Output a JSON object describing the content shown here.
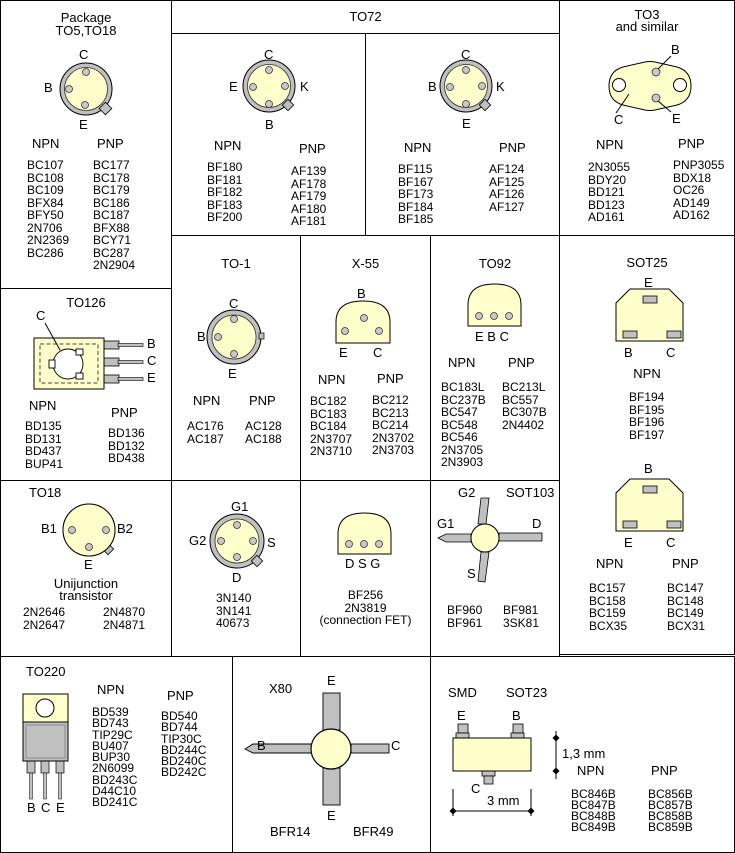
{
  "colors": {
    "body": "#ffffcc",
    "lead": "#c0c0c0",
    "outline": "#000000"
  },
  "to5": {
    "title_line1": "Package",
    "title_line2": "TO5,TO18",
    "pin_c": "C",
    "pin_b": "B",
    "pin_e": "E",
    "npn_label": "NPN",
    "pnp_label": "PNP",
    "npn": [
      "BC107",
      "BC108",
      "BC109",
      "BFX84",
      "BFY50",
      "2N706",
      "2N2369",
      "BC286"
    ],
    "pnp": [
      "BC177",
      "BC178",
      "BC179",
      "BC186",
      "BC187",
      "BFX88",
      "BCY71",
      "BC287",
      "2N2904"
    ]
  },
  "to72": {
    "title": "TO72",
    "left": {
      "pin_c": "C",
      "pin_e": "E",
      "pin_k": "K",
      "pin_b": "B",
      "npn_label": "NPN",
      "pnp_label": "PNP",
      "npn": [
        "BF180",
        "BF181",
        "BF182",
        "BF183",
        "BF200"
      ],
      "pnp": [
        "AF139",
        "AF178",
        "AF179",
        "AF180",
        "AF181"
      ]
    },
    "right": {
      "pin_c": "C",
      "pin_b": "B",
      "pin_k": "K",
      "pin_e": "E",
      "npn_label": "NPN",
      "pnp_label": "PNP",
      "npn": [
        "BF115",
        "BF167",
        "BF173",
        "BF184",
        "BF185"
      ],
      "pnp": [
        "AF124",
        "AF125",
        "AF126",
        "AF127"
      ]
    }
  },
  "to3": {
    "title_line1": "TO3",
    "title_line2": "and similar",
    "pin_b": "B",
    "pin_e": "E",
    "pin_c": "C",
    "npn_label": "NPN",
    "pnp_label": "PNP",
    "npn": [
      "2N3055",
      "BDY20",
      "BD121",
      "BD123",
      "AD161"
    ],
    "pnp": [
      "PNP3055",
      "BDX18",
      "OC26",
      "AD149",
      "AD162"
    ]
  },
  "to126": {
    "title": "TO126",
    "pin_c_top": "C",
    "pin_b": "B",
    "pin_c": "C",
    "pin_e": "E",
    "npn_label": "NPN",
    "pnp_label": "PNP",
    "npn": [
      "BD135",
      "BD131",
      "BD437",
      "BUP41"
    ],
    "pnp": [
      "BD136",
      "BD132",
      "BD438"
    ]
  },
  "to1": {
    "title": "TO-1",
    "pin_c": "C",
    "pin_b": "B",
    "pin_e": "E",
    "npn_label": "NPN",
    "pnp_label": "PNP",
    "npn": [
      "AC176",
      "AC187"
    ],
    "pnp": [
      "AC128",
      "AC188"
    ]
  },
  "x55": {
    "title": "X-55",
    "pin_b": "B",
    "pin_e": "E",
    "pin_c": "C",
    "npn_label": "NPN",
    "pnp_label": "PNP",
    "npn": [
      "BC182",
      "BC183",
      "BC184",
      "2N3707",
      "2N3710"
    ],
    "pnp": [
      "BC212",
      "BC213",
      "BC214",
      "2N3702",
      "2N3703"
    ]
  },
  "to92": {
    "title": "TO92",
    "pins_label": "E B C",
    "npn_label": "NPN",
    "pnp_label": "PNP",
    "npn": [
      "BC183L",
      "BC237B",
      "BC547",
      "BC548",
      "BC546",
      "2N3705",
      "2N3903"
    ],
    "pnp": [
      "BC213L",
      "BC557",
      "BC307B",
      "2N4402"
    ]
  },
  "sot25": {
    "title": "SOT25",
    "top": {
      "pin_e": "E",
      "pin_b": "B",
      "pin_c": "C",
      "npn_label": "NPN",
      "npn": [
        "BF194",
        "BF195",
        "BF196",
        "BF197"
      ]
    },
    "bottom": {
      "pin_b": "B",
      "pin_e": "E",
      "pin_c": "C",
      "npn_label": "NPN",
      "pnp_label": "PNP",
      "npn": [
        "BC157",
        "BC158",
        "BC159",
        "BCX35"
      ],
      "pnp": [
        "BC147",
        "BC148",
        "BC149",
        "BCX31"
      ]
    }
  },
  "to18": {
    "title": "TO18",
    "pin_b1": "B1",
    "pin_b2": "B2",
    "pin_e": "E",
    "subtitle_line1": "Unijunction",
    "subtitle_line2": "transistor",
    "col1": [
      "2N2646",
      "2N2647"
    ],
    "col2": [
      "2N4870",
      "2N4871"
    ]
  },
  "dualgate": {
    "pin_g1": "G1",
    "pin_g2": "G2",
    "pin_s": "S",
    "pin_d": "D",
    "parts": [
      "3N140",
      "3N141",
      "40673"
    ]
  },
  "fet": {
    "pins_label": "D S G",
    "parts": [
      "BF256",
      "2N3819",
      "(connection FET)"
    ]
  },
  "sot103": {
    "title": "SOT103",
    "pin_g2": "G2",
    "pin_g1": "G1",
    "pin_d": "D",
    "pin_s": "S",
    "col1": [
      "BF960",
      "BF961"
    ],
    "col2": [
      "BF981",
      "3SK81"
    ]
  },
  "to220": {
    "title": "TO220",
    "pin_b": "B",
    "pin_c": "C",
    "pin_e": "E",
    "npn_label": "NPN",
    "pnp_label": "PNP",
    "npn": [
      "BD539",
      "BD743",
      "TIP29C",
      "BU407",
      "BUP30",
      "2N6099",
      "BD243C",
      "D44C10",
      "BD241C"
    ],
    "pnp": [
      "BD540",
      "BD744",
      "TIP30C",
      "BD244C",
      "BD240C",
      "BD242C"
    ]
  },
  "x80": {
    "title": "X80",
    "pin_e_top": "E",
    "pin_b": "B",
    "pin_c": "C",
    "pin_e_bottom": "E",
    "part1": "BFR14",
    "part2": "BFR49"
  },
  "sot23": {
    "smd_label": "SMD",
    "title": "SOT23",
    "pin_e": "E",
    "pin_b": "B",
    "pin_c": "C",
    "dim_height": "1,3 mm",
    "dim_width": "3 mm",
    "npn_label": "NPN",
    "pnp_label": "PNP",
    "npn": [
      "BC846B",
      "BC847B",
      "BC848B",
      "BC849B"
    ],
    "pnp": [
      "BC856B",
      "BC857B",
      "BC858B",
      "BC859B"
    ]
  }
}
